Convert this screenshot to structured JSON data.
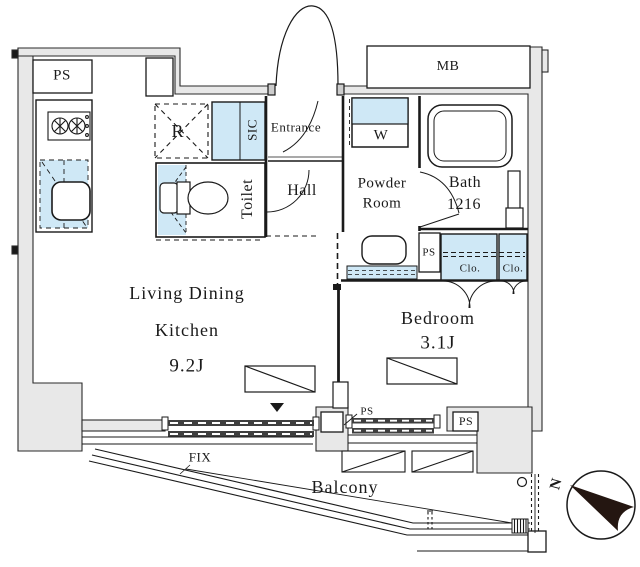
{
  "title": "apartment-floor-plan",
  "rooms": {
    "ldk": {
      "line1": "Living Dining",
      "line2": "Kitchen",
      "size": "9.2J"
    },
    "bedroom": {
      "label": "Bedroom",
      "size": "3.1J"
    },
    "bath": {
      "label": "Bath",
      "size": "1216"
    },
    "powder_room": {
      "line1": "Powder",
      "line2": "Room"
    },
    "toilet": {
      "label": "Toilet"
    },
    "hall": {
      "label": "Hall"
    },
    "entrance": {
      "label": "Entrance"
    },
    "balcony": {
      "label": "Balcony"
    }
  },
  "labels": {
    "meter_box": "MB",
    "pipe_shaft_top_left": "PS",
    "pipe_shaft_bath": "PS",
    "pipe_shaft_mid": "PS",
    "pipe_shaft_right": "PS",
    "shoe_closet": "SIC",
    "refrigerator": "R",
    "washer": "W",
    "closet_left": "Clo.",
    "closet_right": "Clo.",
    "fixed_window": "FIX",
    "north": "N"
  },
  "colors": {
    "fixture_fill": "#cfe8f6",
    "wall_fill": "#e8e8e8",
    "line": "#1a1a1a",
    "window_bar": "#3f3f3f",
    "compass_arrow": "#241611"
  }
}
